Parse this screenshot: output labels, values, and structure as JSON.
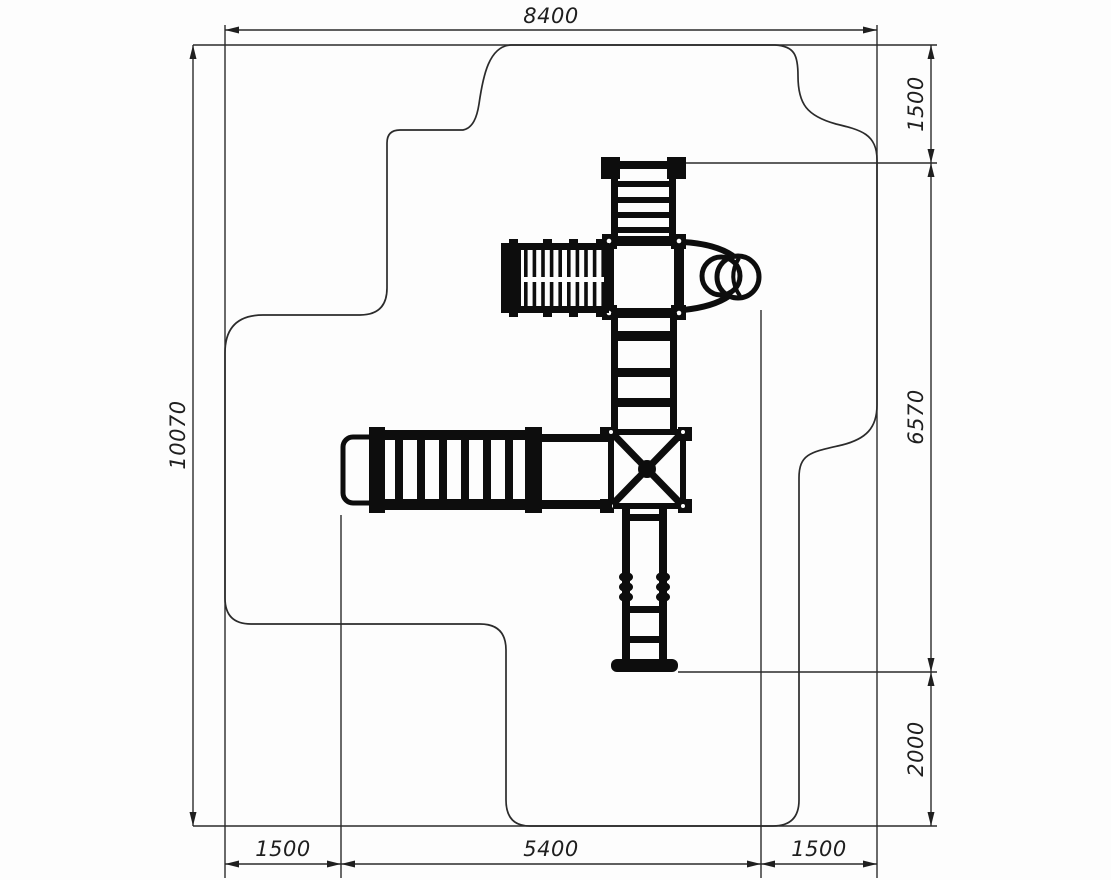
{
  "drawing": {
    "type": "playground-equipment-plan-view-with-safety-zone",
    "background": "#fdfdfd",
    "line_color": "#2b2b2b",
    "structure_color": "#0d0d0d",
    "dimensions": {
      "width_total": "8400",
      "height_total": "10070",
      "right_top": "1500",
      "right_middle": "6570",
      "right_bottom": "2000",
      "bottom_left": "1500",
      "bottom_center": "5400",
      "bottom_right": "1500"
    }
  }
}
